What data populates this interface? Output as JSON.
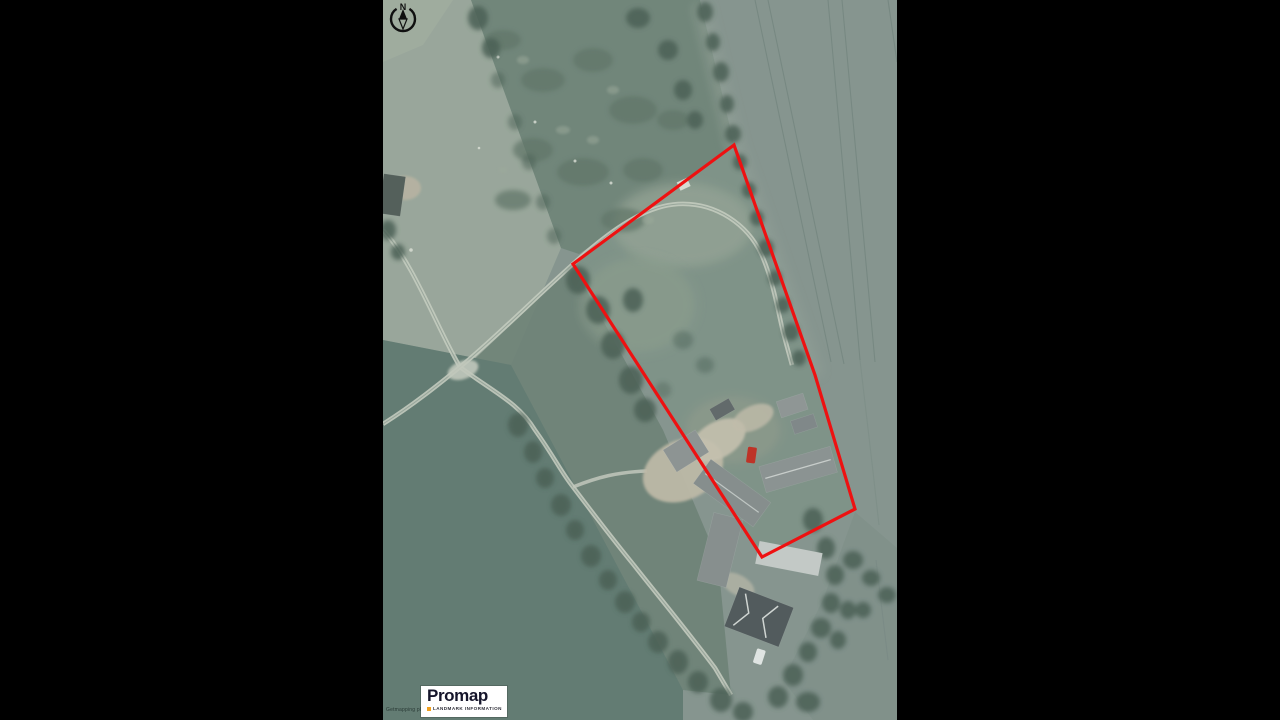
{
  "window": {
    "width": 1280,
    "height": 720,
    "letterbox_color": "#000000"
  },
  "map": {
    "kind": "aerial-photo-export",
    "offset_x": 383,
    "width": 514,
    "height": 720,
    "north_arrow": {
      "label": "N"
    },
    "copyright_text": "Getmapping plc 2011",
    "site_boundary": {
      "color": "#ee1111",
      "stroke_width": 3.2,
      "points": [
        [
          351,
          145
        ],
        [
          190,
          264
        ],
        [
          379,
          557
        ],
        [
          472,
          509
        ],
        [
          432,
          375
        ]
      ]
    }
  },
  "logo": {
    "brand": "Promap",
    "tagline": "LANDMARK INFORMATION",
    "background": "#ffffff",
    "brand_color": "#15152b",
    "bullet_color": "#f0a01e",
    "tagline_color": "#2e2e38"
  },
  "palette": {
    "arable_field": "#86958f",
    "scrub_field": "#6f8478",
    "light_field": "#9ba89c",
    "pasture_field": "#5f7970",
    "paddock": "#7e9287",
    "track": "#cbd0c4",
    "farmyard": "#c3bca9",
    "trees": "#445a4f",
    "roof_gray": "#8c9292",
    "roof_dark": "#4c5457",
    "roof_light": "#cacfcc",
    "red_vehicle": "#c4271b"
  }
}
